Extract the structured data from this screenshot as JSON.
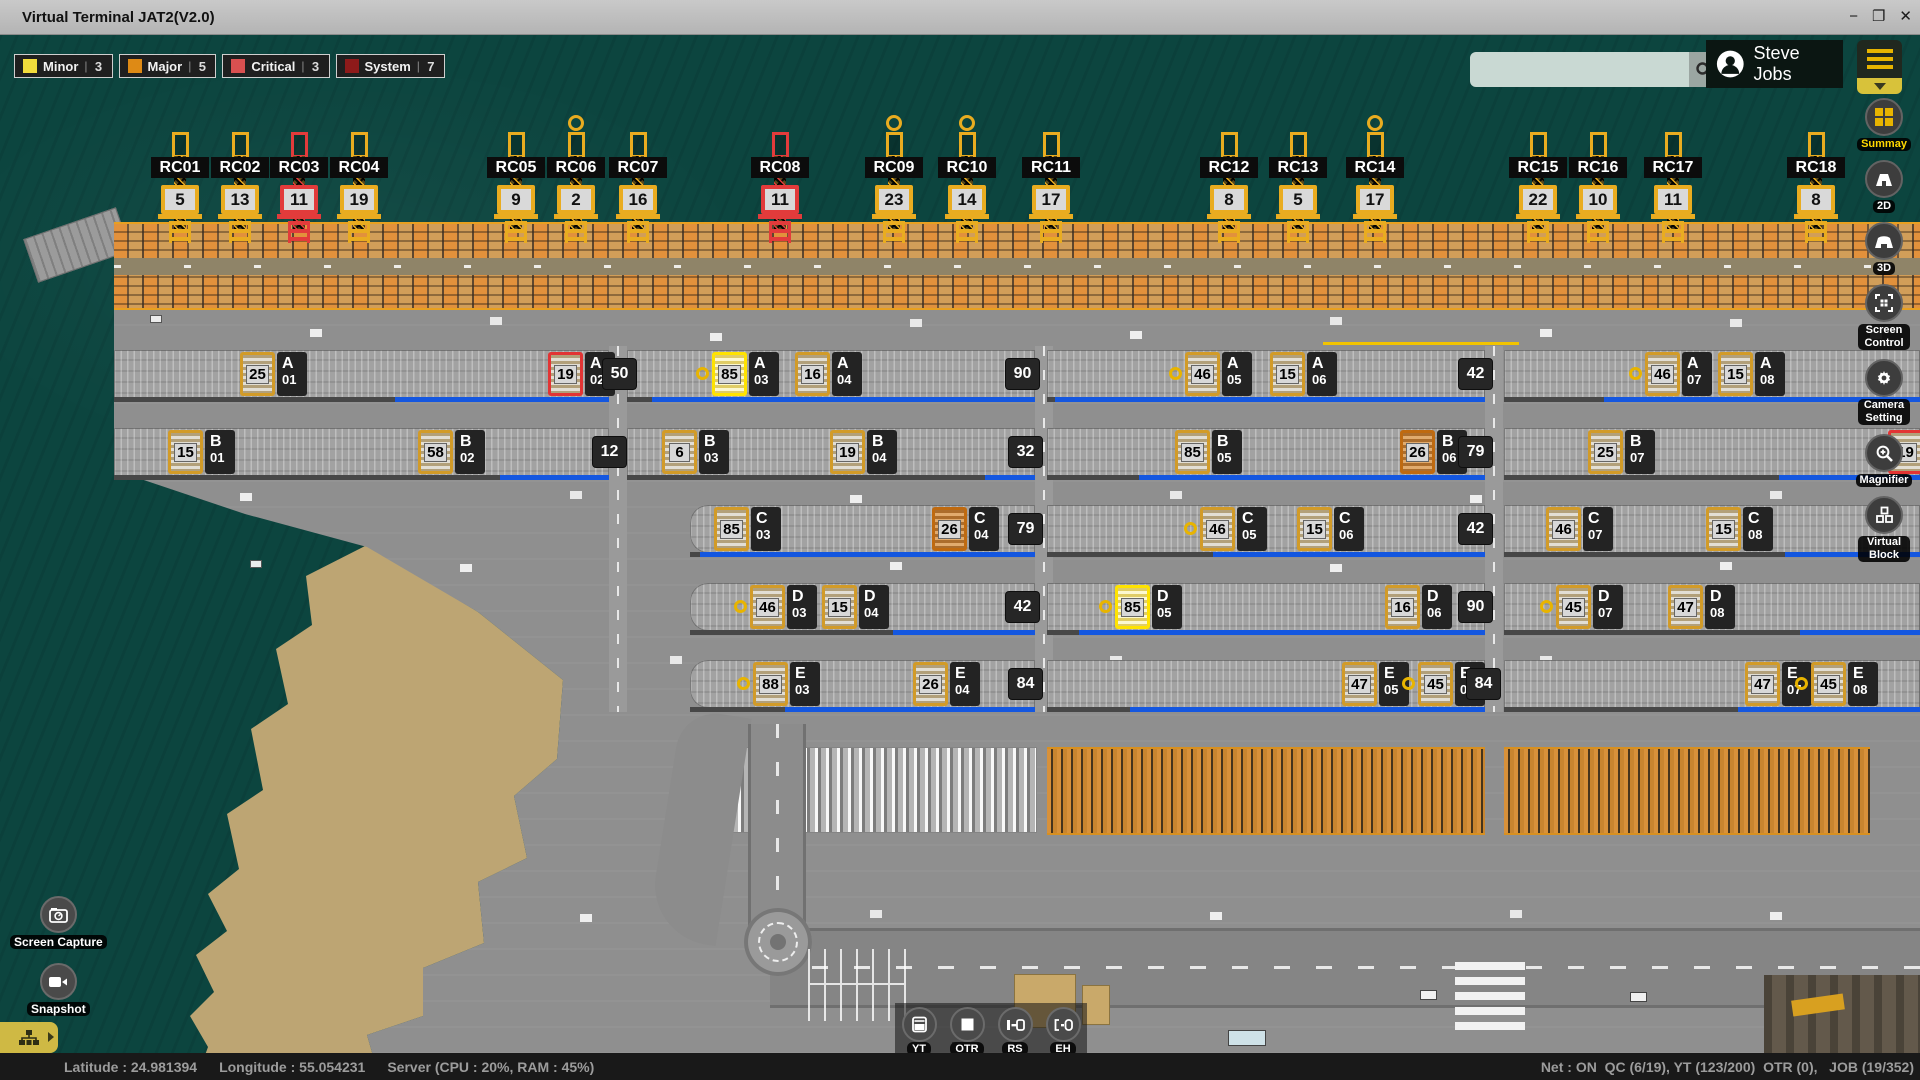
{
  "window": {
    "title": "Virtual Terminal JAT2(V2.0)",
    "minimize": "−",
    "maximize": "❐",
    "close": "✕"
  },
  "alarm_badges": [
    {
      "label": "Minor",
      "count": 3,
      "color": "#f2dc3c",
      "sep": "|"
    },
    {
      "label": "Major",
      "count": 5,
      "color": "#de8a15",
      "sep": "|"
    },
    {
      "label": "Critical",
      "count": 3,
      "color": "#d95050",
      "sep": "|"
    },
    {
      "label": "System",
      "count": 7,
      "color": "#8e1a1a",
      "sep": "|"
    }
  ],
  "topbar": {
    "search_value": "",
    "user_name": "Steve Jobs"
  },
  "side_tools": [
    {
      "label": "Summay",
      "active": true
    },
    {
      "label": "2D"
    },
    {
      "label": "3D"
    },
    {
      "label": "Screen Control"
    },
    {
      "label": "Camera Setting"
    },
    {
      "label": "Magnifier"
    },
    {
      "label": "Virtual Block"
    }
  ],
  "quick_buttons": [
    {
      "label": "Screen Capture"
    },
    {
      "label": "Snapshot"
    }
  ],
  "bottom_tools": [
    {
      "label": "YT"
    },
    {
      "label": "OTR"
    },
    {
      "label": "RS"
    },
    {
      "label": "EH"
    }
  ],
  "status_bar": {
    "latitude": "Latitude : 24.981394",
    "longitude": "Longitude : 55.054231",
    "server": "Server (CPU : 20%, RAM : 45%)",
    "net": "Net : ON  QC (6/19), YT (123/200)  OTR (0),   JOB (19/352)"
  },
  "colors": {
    "accent_yellow": "#e8b400",
    "critical_red": "#e23434",
    "major_orange": "#bf6a10",
    "selected_yellow": "#ffe300",
    "progress_blue": "#1457e0"
  },
  "cranes": [
    {
      "id": "RC01",
      "x": 180,
      "count": 5
    },
    {
      "id": "RC02",
      "x": 240,
      "count": 13
    },
    {
      "id": "RC03",
      "x": 299,
      "count": 11,
      "critical": true
    },
    {
      "id": "RC04",
      "x": 359,
      "count": 19
    },
    {
      "id": "RC05",
      "x": 516,
      "count": 9
    },
    {
      "id": "RC06",
      "x": 576,
      "count": 2,
      "marker": true
    },
    {
      "id": "RC07",
      "x": 638,
      "count": 16
    },
    {
      "id": "RC08",
      "x": 780,
      "count": 11,
      "critical": true
    },
    {
      "id": "RC09",
      "x": 894,
      "count": 23,
      "marker": true
    },
    {
      "id": "RC10",
      "x": 967,
      "count": 14,
      "marker": true
    },
    {
      "id": "RC11",
      "x": 1051,
      "count": 17
    },
    {
      "id": "RC12",
      "x": 1229,
      "count": 8
    },
    {
      "id": "RC13",
      "x": 1298,
      "count": 5
    },
    {
      "id": "RC14",
      "x": 1375,
      "count": 17,
      "marker": true
    },
    {
      "id": "RC15",
      "x": 1538,
      "count": 22
    },
    {
      "id": "RC16",
      "x": 1598,
      "count": 10
    },
    {
      "id": "RC17",
      "x": 1673,
      "count": 11
    },
    {
      "id": "RC18",
      "x": 1816,
      "count": 8
    }
  ],
  "yard": {
    "rows": [
      {
        "row": "A",
        "y": 350,
        "segments": [
          {
            "x1": 114,
            "x2": 609,
            "blue": [
              395,
              609
            ]
          },
          {
            "x1": 627,
            "x2": 1035,
            "blue": [
              652,
              1035
            ]
          },
          {
            "x1": 1047,
            "x2": 1485,
            "blue": [
              1055,
              1485
            ]
          },
          {
            "x1": 1504,
            "x2": 1920,
            "blue": [
              1604,
              1920
            ]
          }
        ],
        "blocks": [
          {
            "bay": "01",
            "count": 25,
            "x": 240,
            "style": "normal"
          },
          {
            "bay": "02",
            "count": 19,
            "x": 548,
            "style": "critical"
          },
          {
            "bay": "03",
            "count": 85,
            "x": 712,
            "style": "selected",
            "marker": true
          },
          {
            "bay": "04",
            "count": 16,
            "x": 795,
            "style": "normal"
          },
          {
            "bay": "05",
            "count": 46,
            "x": 1185,
            "style": "normal",
            "marker": true
          },
          {
            "bay": "06",
            "count": 15,
            "x": 1270,
            "style": "normal"
          },
          {
            "bay": "07",
            "count": 46,
            "x": 1645,
            "style": "normal",
            "marker": true
          },
          {
            "bay": "08",
            "count": 15,
            "x": 1718,
            "style": "normal"
          }
        ],
        "ends": [
          {
            "value": 50,
            "x": 602
          },
          {
            "value": 90,
            "x": 1005
          },
          {
            "value": 42,
            "x": 1458
          }
        ]
      },
      {
        "row": "B",
        "y": 428,
        "segments": [
          {
            "x1": 114,
            "x2": 609,
            "blue": [
              500,
              609
            ]
          },
          {
            "x1": 627,
            "x2": 1035,
            "blue": [
              985,
              1035
            ]
          },
          {
            "x1": 1047,
            "x2": 1485,
            "blue": [
              1139,
              1485
            ]
          },
          {
            "x1": 1504,
            "x2": 1920,
            "blue": [
              1779,
              1920
            ]
          }
        ],
        "blocks": [
          {
            "bay": "01",
            "count": 15,
            "x": 168,
            "style": "normal"
          },
          {
            "bay": "02",
            "count": 58,
            "x": 418,
            "style": "normal"
          },
          {
            "bay": "03",
            "count": 6,
            "x": 662,
            "style": "normal"
          },
          {
            "bay": "04",
            "count": 19,
            "x": 830,
            "style": "normal"
          },
          {
            "bay": "05",
            "count": 85,
            "x": 1175,
            "style": "normal"
          },
          {
            "bay": "06",
            "count": 26,
            "x": 1400,
            "style": "major"
          },
          {
            "bay": "07",
            "count": 25,
            "x": 1588,
            "style": "normal"
          },
          {
            "bay": "08",
            "count": 19,
            "x": 1888,
            "style": "critical",
            "iconOnly": true
          }
        ],
        "ends": [
          {
            "value": 12,
            "x": 592
          },
          {
            "value": 32,
            "x": 1008
          },
          {
            "value": 79,
            "x": 1458
          }
        ]
      },
      {
        "row": "C",
        "y": 505,
        "segments": [
          {
            "x1": 690,
            "x2": 1035,
            "blue": [
              700,
              1035
            ],
            "cap": true
          },
          {
            "x1": 1047,
            "x2": 1485,
            "blue": [
              1213,
              1485
            ]
          },
          {
            "x1": 1504,
            "x2": 1920,
            "blue": [
              1785,
              1920
            ]
          }
        ],
        "blocks": [
          {
            "bay": "03",
            "count": 85,
            "x": 714,
            "style": "normal"
          },
          {
            "bay": "04",
            "count": 26,
            "x": 932,
            "style": "major"
          },
          {
            "bay": "05",
            "count": 46,
            "x": 1200,
            "style": "normal",
            "marker": true
          },
          {
            "bay": "06",
            "count": 15,
            "x": 1297,
            "style": "normal"
          },
          {
            "bay": "07",
            "count": 46,
            "x": 1546,
            "style": "normal"
          },
          {
            "bay": "08",
            "count": 15,
            "x": 1706,
            "style": "normal"
          }
        ],
        "ends": [
          {
            "value": 79,
            "x": 1008
          },
          {
            "value": 42,
            "x": 1458
          }
        ]
      },
      {
        "row": "D",
        "y": 583,
        "segments": [
          {
            "x1": 690,
            "x2": 1035,
            "blue": [
              893,
              1035
            ],
            "cap": true
          },
          {
            "x1": 1047,
            "x2": 1485,
            "blue": [
              1079,
              1485
            ]
          },
          {
            "x1": 1504,
            "x2": 1920,
            "blue": [
              1800,
              1920
            ]
          }
        ],
        "blocks": [
          {
            "bay": "03",
            "count": 46,
            "x": 750,
            "style": "normal",
            "marker": true
          },
          {
            "bay": "04",
            "count": 15,
            "x": 822,
            "style": "normal"
          },
          {
            "bay": "05",
            "count": 85,
            "x": 1115,
            "style": "selected",
            "marker": true
          },
          {
            "bay": "06",
            "count": 16,
            "x": 1385,
            "style": "normal"
          },
          {
            "bay": "07",
            "count": 45,
            "x": 1556,
            "style": "normal",
            "marker": true
          },
          {
            "bay": "08",
            "count": 47,
            "x": 1668,
            "style": "normal"
          }
        ],
        "ends": [
          {
            "value": 42,
            "x": 1005
          },
          {
            "value": 90,
            "x": 1458
          }
        ]
      },
      {
        "row": "E",
        "y": 660,
        "segments": [
          {
            "x1": 690,
            "x2": 1035,
            "blue": [
              785,
              1035
            ],
            "cap": true
          },
          {
            "x1": 1047,
            "x2": 1485,
            "blue": [
              1130,
              1485
            ]
          },
          {
            "x1": 1504,
            "x2": 1920,
            "blue": [
              1738,
              1920
            ]
          }
        ],
        "blocks": [
          {
            "bay": "03",
            "count": 88,
            "x": 753,
            "style": "normal",
            "marker": true
          },
          {
            "bay": "04",
            "count": 26,
            "x": 913,
            "style": "normal"
          },
          {
            "bay": "05",
            "count": 47,
            "x": 1342,
            "style": "normal"
          },
          {
            "bay": "06",
            "count": 45,
            "x": 1418,
            "style": "normal",
            "marker": true
          },
          {
            "bay": "07",
            "count": 47,
            "x": 1745,
            "style": "normal"
          },
          {
            "bay": "08",
            "count": 45,
            "x": 1811,
            "style": "normal",
            "marker": true
          }
        ],
        "ends": [
          {
            "value": 84,
            "x": 1008
          },
          {
            "value": 84,
            "x": 1466
          }
        ]
      }
    ]
  }
}
